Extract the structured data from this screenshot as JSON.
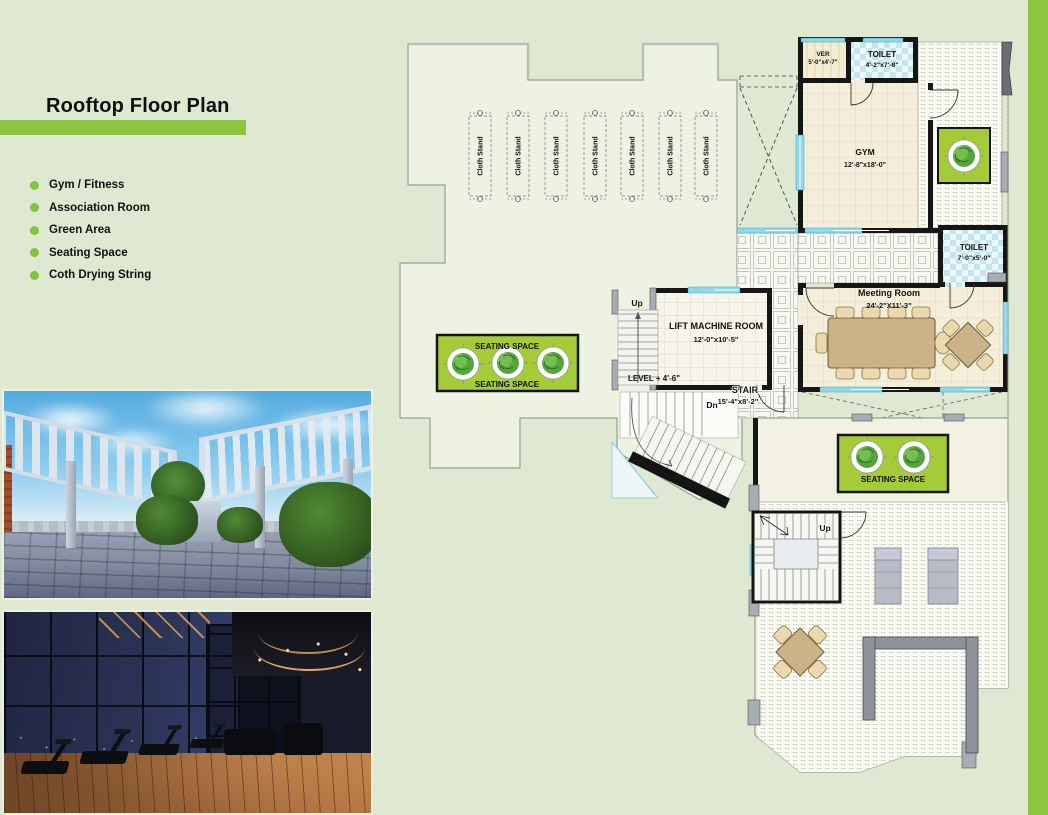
{
  "page": {
    "accent_green": "#8cc640",
    "background_green": "#dfe9d1",
    "seating_green": "#a6cb39"
  },
  "sidebar": {
    "title": "Rooftop Floor Plan",
    "bullets": [
      "Gym / Fitness",
      "Association Room",
      "Green Area",
      "Seating Space",
      "Coth Drying String"
    ]
  },
  "plan": {
    "rooms": {
      "ver": {
        "name": "VER",
        "dims": "5'-0\"x4'-7\""
      },
      "toilet_top": {
        "name": "TOILET",
        "dims": "4'-2\"x7'-8\""
      },
      "gym": {
        "name": "GYM",
        "dims": "12'-8\"x18'-0\""
      },
      "toilet_right": {
        "name": "TOILET",
        "dims": "7'-0\"x5'-0\""
      },
      "meeting_room": {
        "name": "Meeting Room",
        "dims": "24'-2\"X11'-3\""
      },
      "lift_machine_room": {
        "name": "LIFT MACHINE ROOM",
        "dims": "12'-0\"x10'-5\""
      },
      "stair": {
        "name": "STAIR",
        "dims": "15'-4\"x8'-2\""
      }
    },
    "labels": {
      "cloth_stand": "Cloth Stand",
      "seating_space": "SEATING SPACE",
      "level": "LEVEL + 4'-6\"",
      "up": "Up",
      "down": "Dn"
    }
  }
}
